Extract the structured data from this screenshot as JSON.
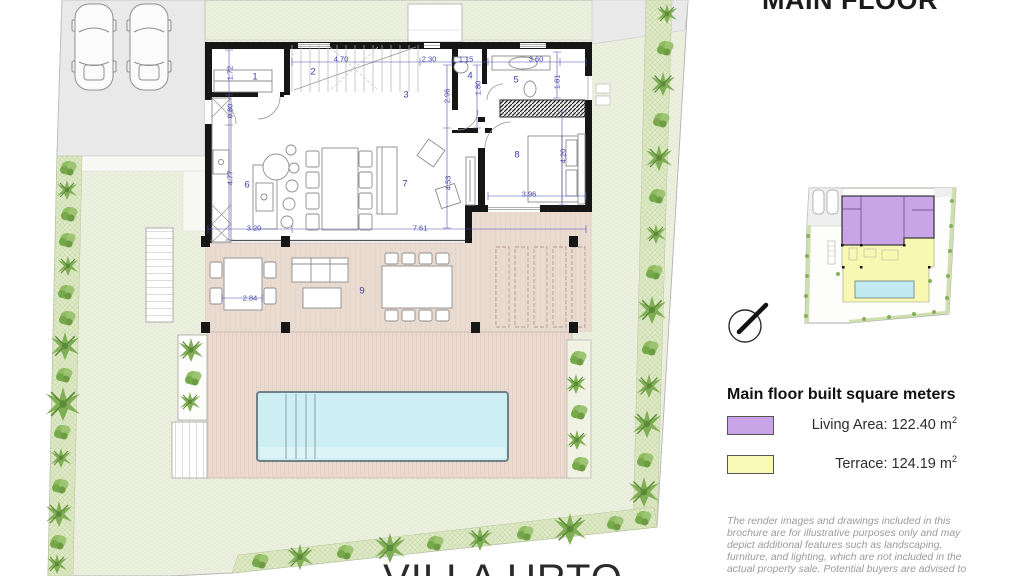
{
  "plan": {
    "rooms": [
      {
        "number": "1"
      },
      {
        "number": "2"
      },
      {
        "number": "3"
      },
      {
        "number": "4"
      },
      {
        "number": "5"
      },
      {
        "number": "6"
      },
      {
        "number": "7"
      },
      {
        "number": "8"
      },
      {
        "number": "9"
      }
    ],
    "dimensions": [
      {
        "value": "1.72",
        "orientation": "v"
      },
      {
        "value": "4.70",
        "orientation": "h"
      },
      {
        "value": "2.30",
        "orientation": "h"
      },
      {
        "value": "1.15",
        "orientation": "h"
      },
      {
        "value": "3.60",
        "orientation": "h"
      },
      {
        "value": "1.80",
        "orientation": "v"
      },
      {
        "value": "1.81",
        "orientation": "v"
      },
      {
        "value": "2.96",
        "orientation": "v"
      },
      {
        "value": "0.80",
        "orientation": "v"
      },
      {
        "value": "4.77",
        "orientation": "v"
      },
      {
        "value": "4.53",
        "orientation": "v"
      },
      {
        "value": "4.20",
        "orientation": "v"
      },
      {
        "value": "3.96",
        "orientation": "h"
      },
      {
        "value": "3.20",
        "orientation": "h"
      },
      {
        "value": "7.61",
        "orientation": "h"
      },
      {
        "value": "2.84",
        "orientation": "h"
      }
    ]
  },
  "panel": {
    "title": "MAIN FLOOR",
    "legend": {
      "heading": "Main floor built square meters",
      "items": [
        {
          "name": "living-area",
          "label": "Living Area: 122.40 m",
          "sup": "2",
          "color": "#c9a4e7"
        },
        {
          "name": "terrace",
          "label": "Terrace: 124.19 m",
          "sup": "2",
          "color": "#f9f9b5"
        }
      ]
    },
    "disclaimer_lines": [
      "The render images and drawings included in this",
      "brochure are for illustrative purposes only and may",
      "depict additional features such as landscaping,",
      "furniture, and lighting, which are not included in the",
      "actual property sale. Potential buyers are advised to"
    ]
  },
  "footer": {
    "villa_name": "VILLA URTO"
  },
  "colors": {
    "lawn": "#edf0e1",
    "hedge": "#dfe9c8",
    "deck": "#ebdacf",
    "terrace_floor": "#eadbd1",
    "pool": "#cdeff3",
    "driveway": "#e9e9e9",
    "walls": "#161616",
    "dimension_blue": "#3f3fae",
    "living_highlight": "#c9a4e7",
    "terrace_highlight": "#f9f9b5"
  }
}
